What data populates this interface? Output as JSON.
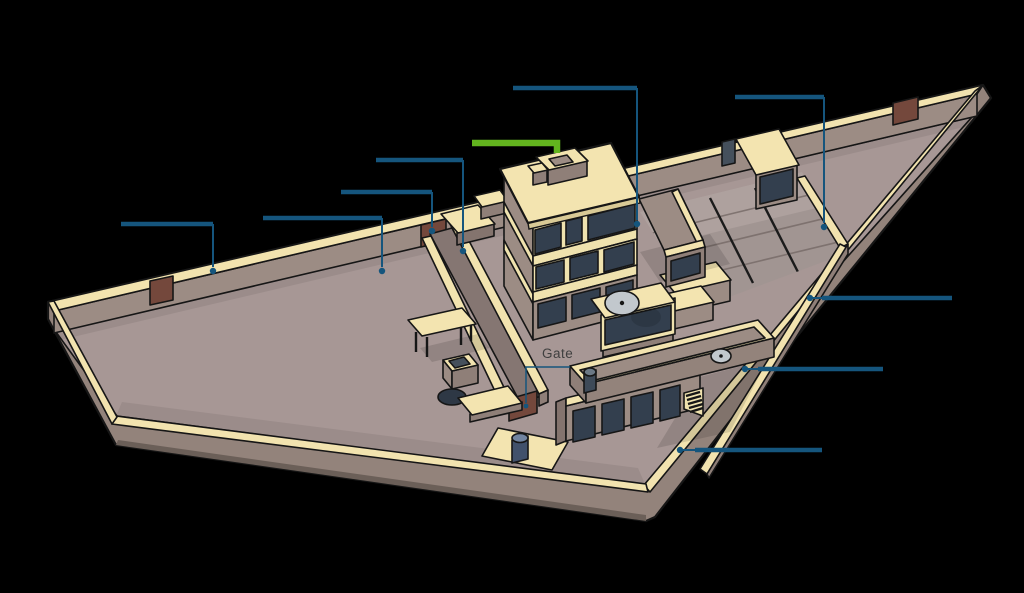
{
  "page": {
    "width": 1024,
    "height": 593,
    "background": "#000000",
    "description_tag": "isometric-walled-compound-diagram"
  },
  "labels": {
    "gate": "Gate"
  },
  "colors": {
    "callout_blue": "#15557D",
    "callout_green": "#62B41E",
    "wall_top_cream": "#F2E3AF",
    "roof_cream": "#F3E4B0",
    "wall_taupe": "#9C8C84",
    "wall_taupe_shaded": "#8F7F78",
    "outer_wall_face": "#93837B",
    "ground_mauve": "#A79795",
    "window_slate": "#333F4E",
    "gate_door_brown": "#74483C",
    "satellite_dish_gray": "#C2C8CD",
    "label_text": "#3F3F3F"
  },
  "callouts": {
    "blue_leader_count": 10,
    "green_leader_count": 1,
    "gate_pointer_count": 1,
    "visible_text_labels": [
      "Gate"
    ]
  }
}
